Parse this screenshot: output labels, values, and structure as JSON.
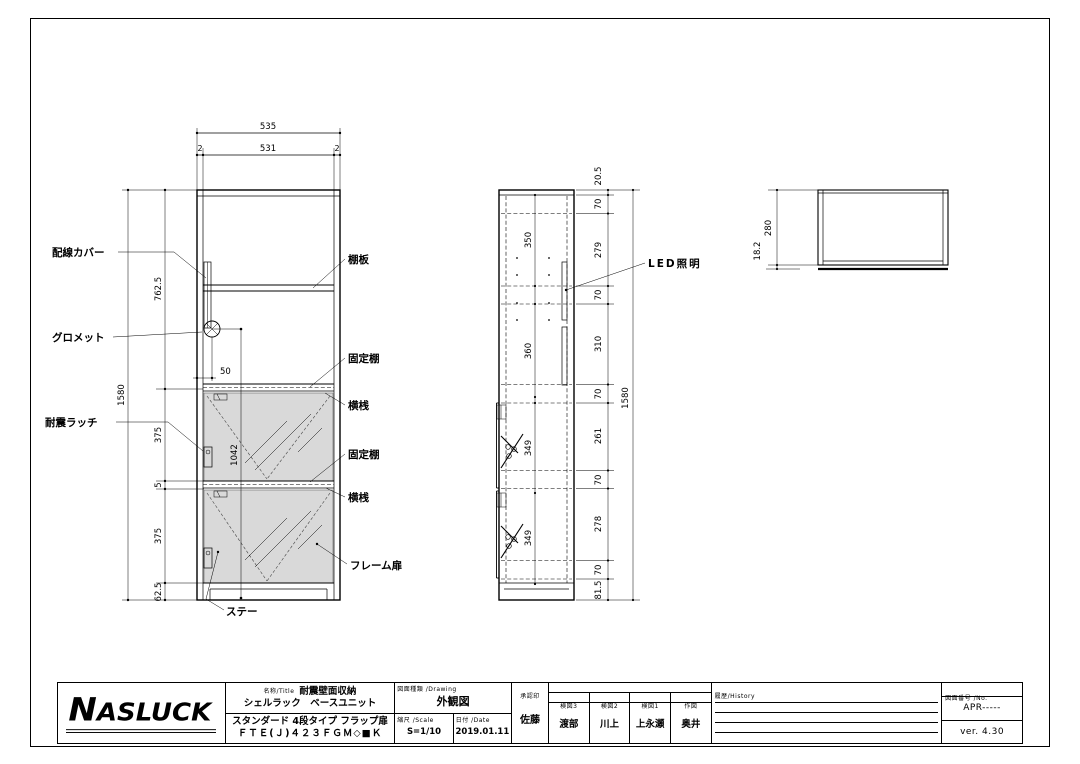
{
  "drawing": {
    "front_view": {
      "dim_width_total": "535",
      "dim_width_parts": [
        "2",
        "531",
        "2"
      ],
      "dim_upper_height": "762.5",
      "dim_total_height": "1580",
      "dim_door1": "375",
      "dim_gap": "5",
      "dim_door2": "375",
      "dim_base": "62.5",
      "dim_grommet_offset": "50",
      "dim_door_span": "1042",
      "label_wiring_cover": "配線カバー",
      "label_grommet": "グロメット",
      "label_latch": "耐震ラッチ",
      "label_stay": "ステー",
      "label_shelf": "棚板",
      "label_fixed_shelf_1": "固定棚",
      "label_rail_1": "横桟",
      "label_fixed_shelf_2": "固定棚",
      "label_rail_2": "横桟",
      "label_frame_door": "フレーム扉"
    },
    "side_view": {
      "dims_inner": [
        "350",
        "360",
        "349",
        "349"
      ],
      "dims_outer": [
        "20.5",
        "70",
        "279",
        "70",
        "310",
        "70",
        "261",
        "70",
        "278",
        "70",
        "81.5"
      ],
      "dim_total": "1580",
      "label_led": "LED照明"
    },
    "top_view": {
      "dim_depth": "280",
      "dim_back_panel": "18.2"
    }
  },
  "title_block": {
    "logo": "NASLUCK",
    "name_label": "名称/Title",
    "product_category": "耐震壁面収納",
    "product_series": "シェルラック　ベースユニット",
    "product_type": "スタンダード 4段タイプ フラップ扉",
    "product_code": "ＦＴＥ(Ｊ)４２３ＦＧＭ◇■Ｋ",
    "drawing_type_label": "図面種類 /Drawing",
    "drawing_type": "外観図",
    "scale_label": "縮尺 /Scale",
    "scale": "S=1/10",
    "date_label": "日付 /Date",
    "date": "2019.01.11",
    "approval_label": "承認印",
    "approver": "佐藤",
    "check_header": "照合者 /Check up by ナスラック㈱ダンテの工場",
    "check_columns": [
      {
        "label": "検図3",
        "name": "渡部"
      },
      {
        "label": "検図2",
        "name": "川上"
      },
      {
        "label": "検図1",
        "name": "上永瀬"
      },
      {
        "label": "作図",
        "name": "奥井"
      }
    ],
    "history_label": "履歴/History",
    "number_label": "図面番号 /No.",
    "number": "APR-----",
    "version": "ver. 4.30"
  }
}
